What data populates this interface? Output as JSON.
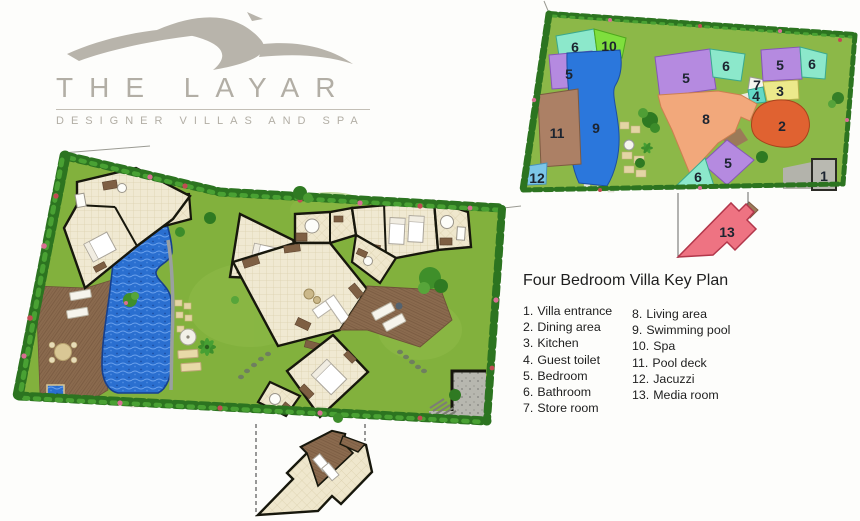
{
  "brand": {
    "name": "THE LAYAR",
    "tagline": "DESIGNER VILLAS AND SPA"
  },
  "legend": {
    "title": "Four Bedroom Villa Key Plan",
    "items": [
      {
        "num": "1.",
        "label": "Villa entrance"
      },
      {
        "num": "2.",
        "label": "Dining area"
      },
      {
        "num": "3.",
        "label": "Kitchen"
      },
      {
        "num": "4.",
        "label": "Guest toilet"
      },
      {
        "num": "5.",
        "label": "Bedroom"
      },
      {
        "num": "6.",
        "label": "Bathroom"
      },
      {
        "num": "7.",
        "label": "Store room"
      },
      {
        "num": "8.",
        "label": "Living area"
      },
      {
        "num": "9.",
        "label": "Swimming pool"
      },
      {
        "num": "10.",
        "label": "Spa"
      },
      {
        "num": "11.",
        "label": "Pool deck"
      },
      {
        "num": "12.",
        "label": "Jacuzzi"
      },
      {
        "num": "13.",
        "label": "Media room"
      }
    ]
  },
  "key_plan": {
    "markers": [
      {
        "room": "bathroom-northwest",
        "number": "6"
      },
      {
        "room": "spa",
        "number": "10"
      },
      {
        "room": "bedroom-west",
        "number": "5"
      },
      {
        "room": "swimming-pool",
        "number": "9"
      },
      {
        "room": "pool-deck",
        "number": "11"
      },
      {
        "room": "jacuzzi",
        "number": "12"
      },
      {
        "room": "bedroom-center",
        "number": "5"
      },
      {
        "room": "bathroom-center",
        "number": "6"
      },
      {
        "room": "store-room",
        "number": "7"
      },
      {
        "room": "bedroom-northeast",
        "number": "5"
      },
      {
        "room": "bathroom-east",
        "number": "6"
      },
      {
        "room": "kitchen",
        "number": "3"
      },
      {
        "room": "guest-toilet",
        "number": "4"
      },
      {
        "room": "living-area",
        "number": "8"
      },
      {
        "room": "dining-area",
        "number": "2"
      },
      {
        "room": "bedroom-south",
        "number": "5"
      },
      {
        "room": "bathroom-south",
        "number": "6"
      },
      {
        "room": "villa-entrance",
        "number": "1"
      },
      {
        "room": "media-room",
        "number": "13"
      }
    ],
    "region_colors": {
      "bedroom": "#b58ae0",
      "bathroom": "#8ce8cb",
      "spa": "#7fdf3d",
      "swimming_pool": "#2b77dc",
      "pool_deck": "#ac8065",
      "jacuzzi": "#7cc6e8",
      "kitchen": "#ece98b",
      "guest_toilet": "#63d9c6",
      "store_room": "#f5f5ef",
      "living_area": "#f2a87b",
      "dining_area": "#e06231",
      "villa_entrance": "#b9b9b1",
      "media_room": "#ee7382"
    }
  }
}
